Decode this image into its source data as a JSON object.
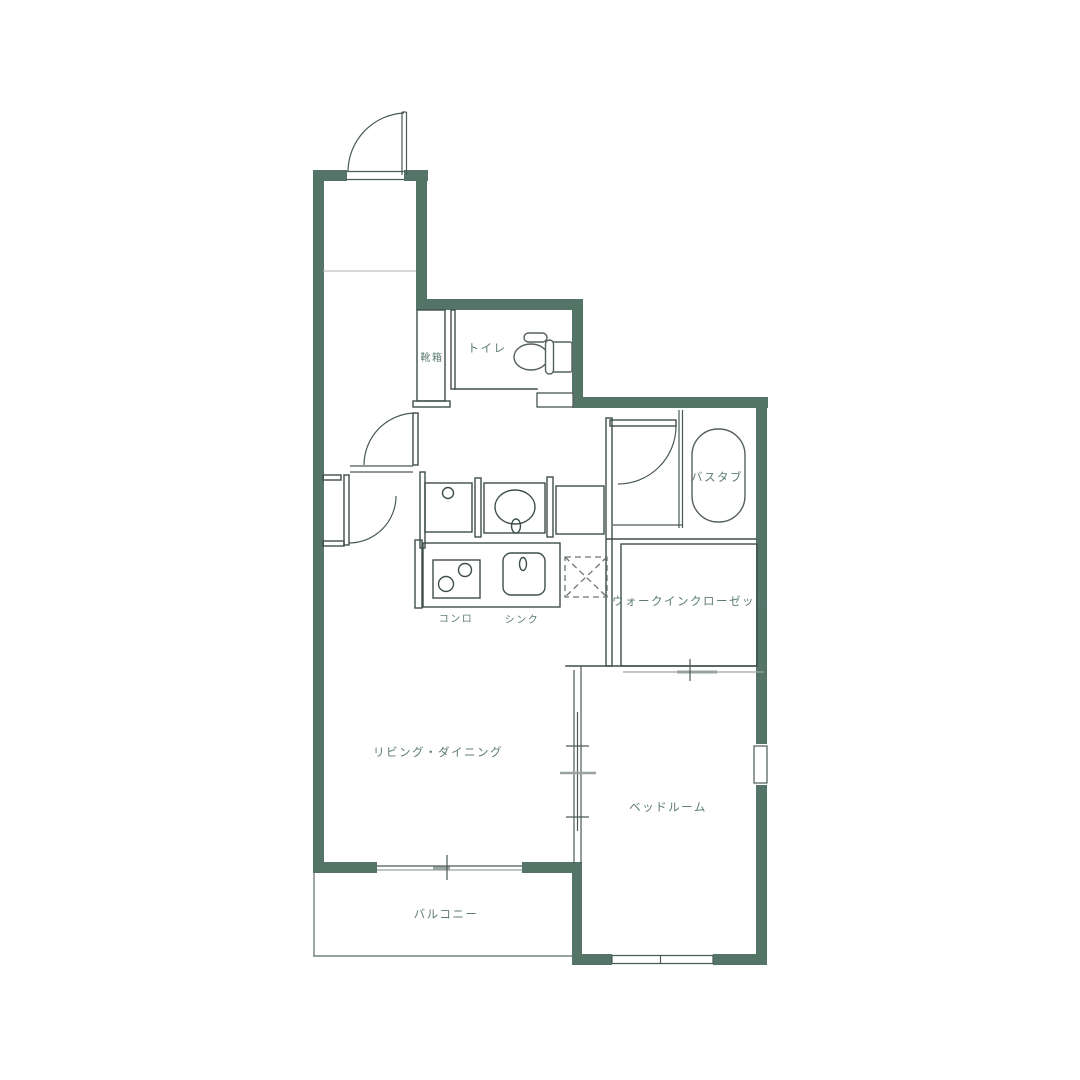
{
  "plan": {
    "type": "floor-plan",
    "colors": {
      "wall": "#547468",
      "line_dark": "#3e4e49",
      "line_gray": "#9aa49f",
      "label_text": "#5c7b70",
      "background": "#ffffff"
    },
    "rooms": {
      "shoebox": {
        "label": "靴箱"
      },
      "toilet": {
        "label": "トイレ"
      },
      "bathtub": {
        "label": "バスタブ"
      },
      "walk_in_closet": {
        "label": "ウォークインクローゼット"
      },
      "stove": {
        "label": "コンロ"
      },
      "sink": {
        "label": "シンク"
      },
      "living_dining": {
        "label": "リビング・ダイニング"
      },
      "bedroom": {
        "label": "ベッドルーム"
      },
      "balcony": {
        "label": "バルコニー"
      }
    },
    "icons": [
      "entry-door-icon",
      "living-door-icon",
      "washroom-door-icon",
      "bath-door-icon",
      "toilet-icon",
      "bathtub-icon",
      "stove-burners-icon",
      "kitchen-sink-icon",
      "washer-space-icon",
      "washbasin-icon",
      "refrigerator-space-icon",
      "sliding-window-icon",
      "sliding-door-icon"
    ]
  }
}
